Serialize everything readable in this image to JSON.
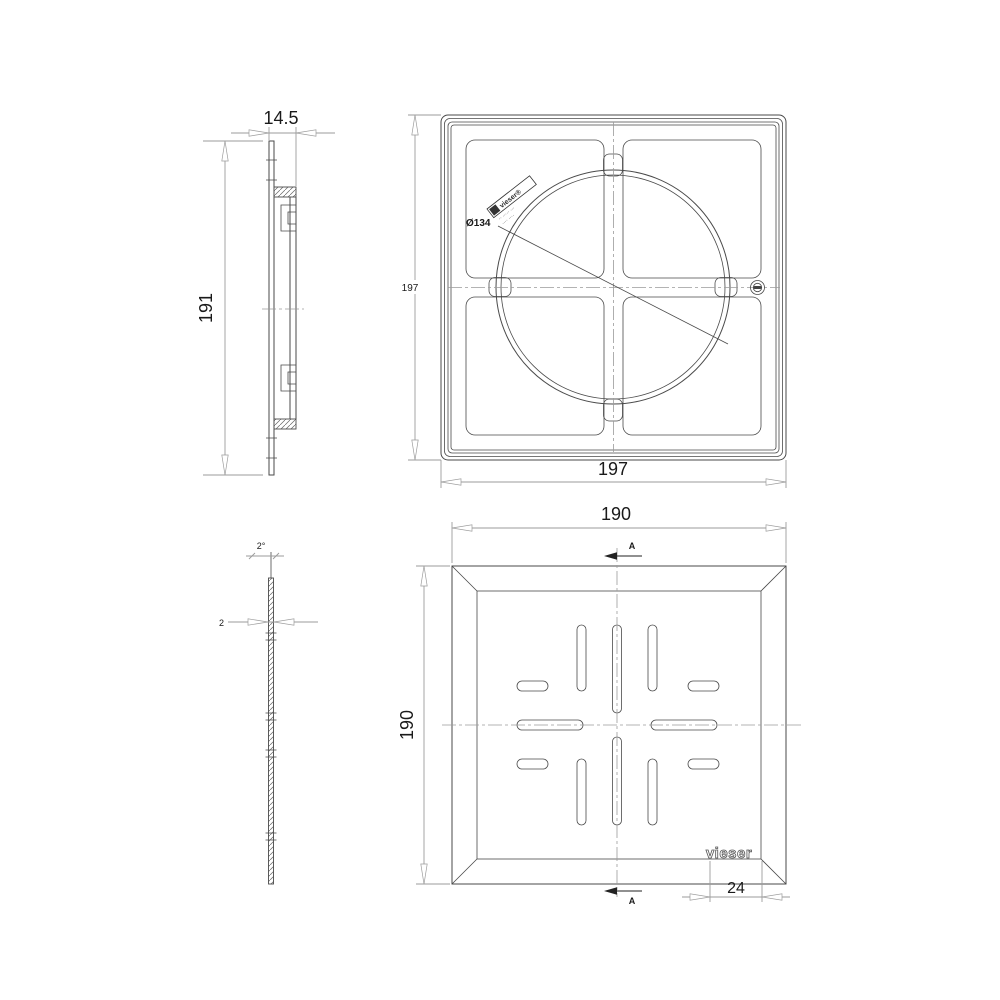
{
  "colors": {
    "background": "#ffffff",
    "object_line": "#4a4a4a",
    "dim_line": "#9b9b9b",
    "text": "#1a1a1a"
  },
  "views": {
    "frame_side": {
      "dims": {
        "width": "14.5",
        "height": "191"
      }
    },
    "frame_front": {
      "dims": {
        "height": "197",
        "width": "197",
        "circle_diameter": "Ø134"
      },
      "stamp": {
        "line1": "vieser®",
        "line2": "·· ····· ···",
        "line3": "···· ····"
      }
    },
    "grate_side": {
      "dims": {
        "thickness": "2",
        "draft_angle": "2°"
      }
    },
    "grate_front": {
      "dims": {
        "width": "190",
        "height": "190",
        "logo_width": "24"
      },
      "section_marker_top": "A",
      "section_marker_bottom": "A",
      "logo": "vieser"
    }
  }
}
